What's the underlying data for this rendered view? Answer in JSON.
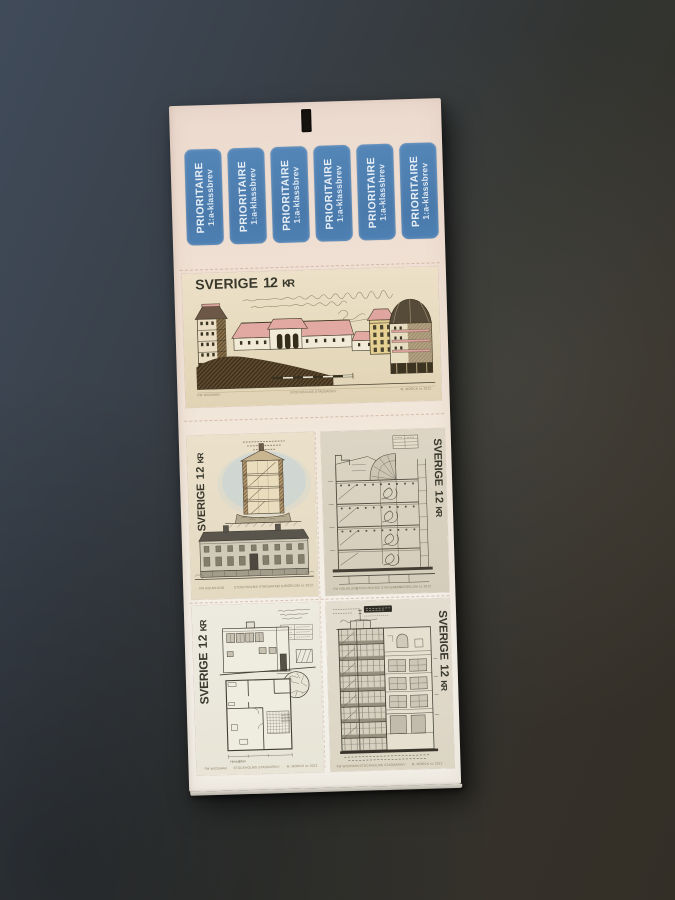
{
  "scene": {
    "description": "Photograph of a Swedish self-adhesive stamp booklet lying on a dark tabletop",
    "surface_color_top_left": "#3e4856",
    "surface_color_bottom_right": "#332f27"
  },
  "booklet": {
    "paper_color": "#f1e4d8",
    "hang_hole": "rectangular punched hanging hole",
    "priority_tabs": {
      "count": 6,
      "line1": "PRIORITAIRE",
      "line2": "1:a-klassbrev",
      "bg_color": "#4e80b3",
      "text_color": "#e4edf6"
    },
    "stamps": [
      {
        "subject": "country estate elevation with flanking tower sections and pink roofs",
        "country": "SVERIGE",
        "value": "12",
        "currency": "KR",
        "caption_left": "FM WICKMAN",
        "caption_center": "STOCKHOLMS STADSARKIV",
        "caption_right": "M. MÖRCK sc 2012"
      },
      {
        "subject": "apartment house cross-section above a long street elevation",
        "country": "SVERIGE",
        "value": "12",
        "currency": "KR",
        "caption_left": "FM HOLMLUND",
        "caption_center": "STOCKHOLMS STADSARKIV",
        "caption_right": "L. SJÖÖBLOM sc 2012"
      },
      {
        "subject": "stairwell section of a multi-storey building with fan roof",
        "country": "SVERIGE",
        "value": "12",
        "currency": "KR",
        "caption_left": "FM HOLMLUND",
        "caption_center": "STOCKHOLMS STADSARKIV",
        "caption_right": "L. SJÖÖBLOM sc 2012"
      },
      {
        "subject": "functionalist villa elevation and ground plan with round stone terrace",
        "plan_label": "Huvudplan",
        "country": "SVERIGE",
        "value": "12",
        "currency": "KR",
        "caption_left": "FM WICKMAN",
        "caption_center": "STOCKHOLMS STADSARKIV",
        "caption_right": "M. MÖRCK sc 2012"
      },
      {
        "subject": "city apartment block facade and section",
        "country": "SVERIGE",
        "value": "12",
        "currency": "KR",
        "caption_left": "FM WICKMAN",
        "caption_center": "STOCKHOLMS STADSARKIV",
        "caption_right": "M. MÖRCK sc 2012"
      }
    ]
  }
}
